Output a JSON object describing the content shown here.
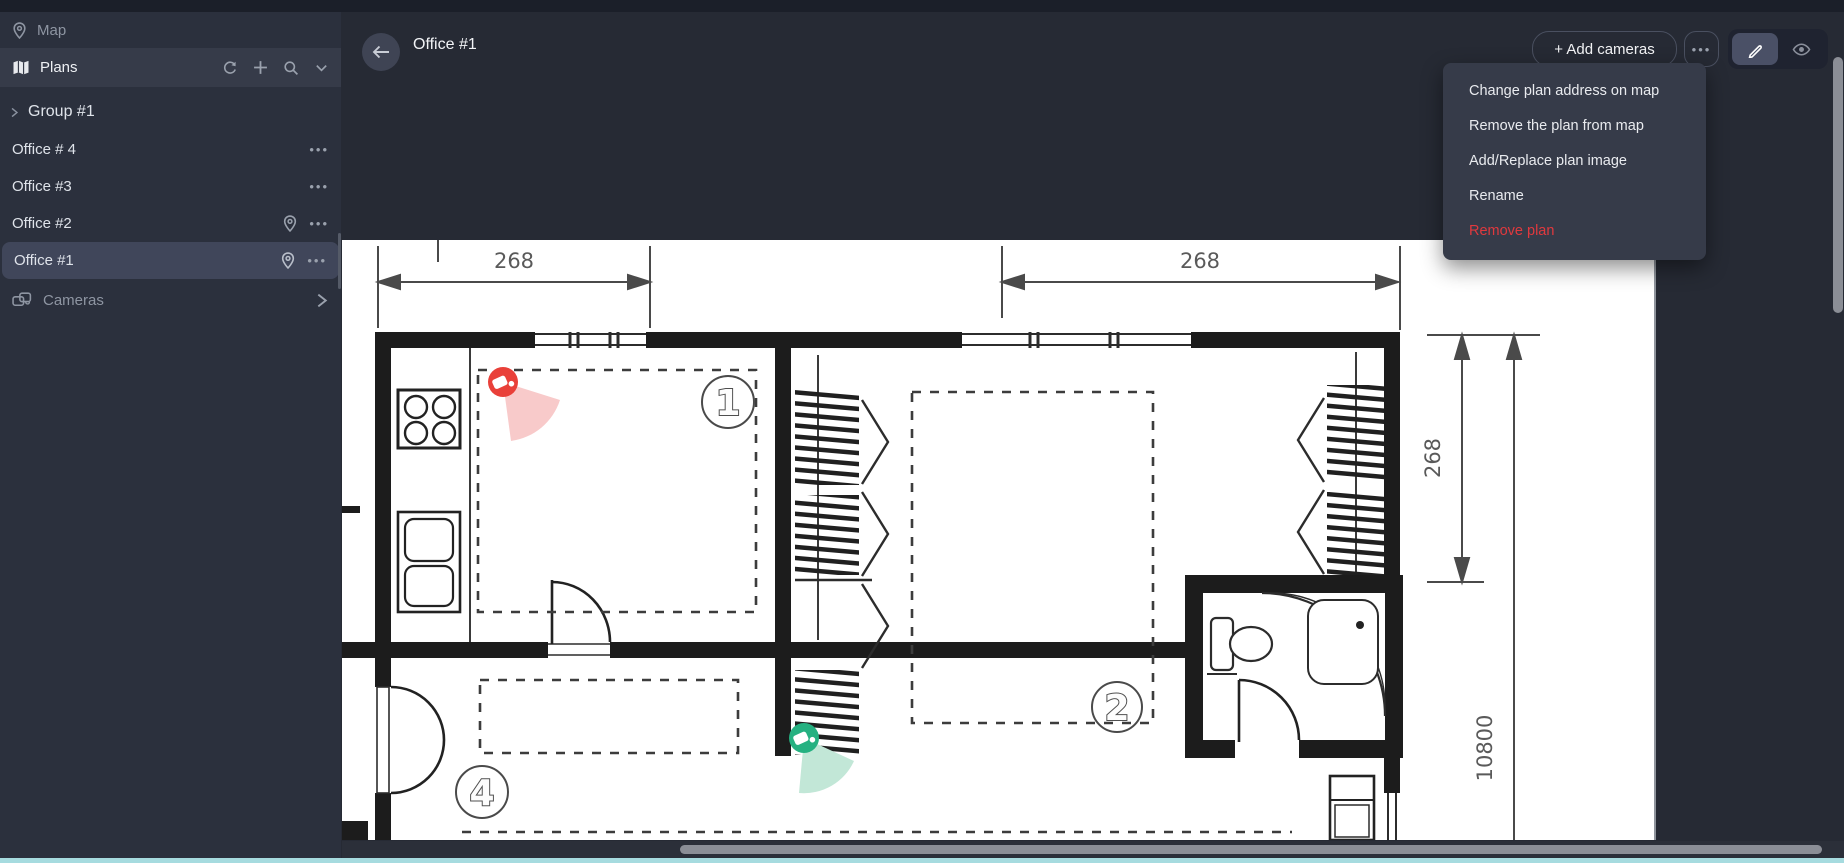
{
  "app": {
    "bottom_bar_color": "#a6dbdf"
  },
  "sidebar": {
    "map_label": "Map",
    "plans_label": "Plans",
    "group_label": "Group #1",
    "items": [
      {
        "label": "Office # 4",
        "has_pin": false,
        "selected": false
      },
      {
        "label": "Office #3",
        "has_pin": false,
        "selected": false
      },
      {
        "label": "Office #2",
        "has_pin": true,
        "selected": false
      },
      {
        "label": "Office #1",
        "has_pin": true,
        "selected": true
      }
    ],
    "cameras_label": "Cameras"
  },
  "header": {
    "title": "Office #1",
    "add_cameras_label": "+ Add cameras"
  },
  "context_menu": {
    "items": [
      {
        "label": "Change plan address on map",
        "danger": false
      },
      {
        "label": "Remove the plan from map",
        "danger": false
      },
      {
        "label": "Add/Replace plan image",
        "danger": false
      },
      {
        "label": "Rename",
        "danger": false
      },
      {
        "label": "Remove plan",
        "danger": true
      }
    ]
  },
  "plan": {
    "dimension_labels": {
      "top_left": "268",
      "top_right": "268",
      "right_depth": "268",
      "right_total": "10800"
    },
    "room_numbers": {
      "room1": "1",
      "room2": "2",
      "room4": "4"
    },
    "camera_markers": [
      {
        "name": "camera-1",
        "color": "#e94039",
        "cone_color": "#f8caca"
      },
      {
        "name": "camera-2",
        "color": "#25b181",
        "cone_color": "#c2e7d7"
      }
    ]
  }
}
